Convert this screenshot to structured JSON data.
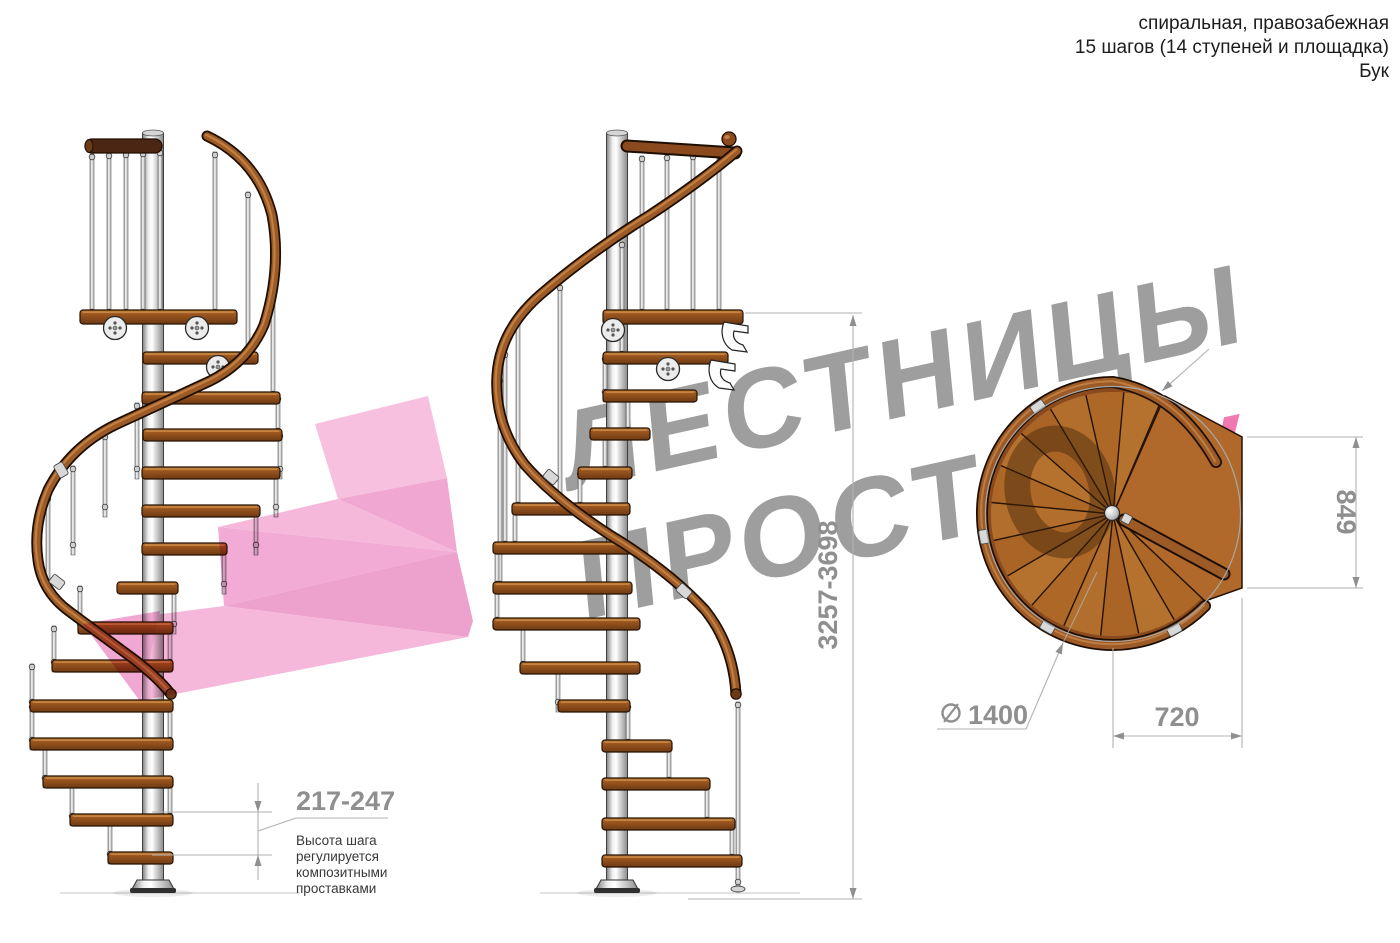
{
  "header": {
    "line1": "спиральная, правозабежная",
    "line2": "15 шагов (14 ступеней и площадка)",
    "line3": "Бук"
  },
  "watermark": {
    "line1": "ЛЕСТНИЦЫ",
    "line2_main": "ПРОСТ",
    "line2_o": "О",
    "line2_suffix": ".ру",
    "gray": "#9e9e9e",
    "pink": "#ef79b0"
  },
  "dimensions": {
    "step_height": "217-247",
    "total_height": "3257-3698",
    "landing_width": "849",
    "landing_depth": "720",
    "diameter_value": "1400",
    "diameter_symbol": "diameter-icon",
    "note_lines": [
      "Высота шага",
      "регулируется",
      "композитными",
      "проставками"
    ]
  },
  "plan": {
    "tread_sectors": 14,
    "has_landing": true
  },
  "colors": {
    "wood": "#a96426",
    "wood_dark": "#6e3a14",
    "rail": "#9c5a26",
    "pole": "#d9d9d9",
    "dim_gray": "#8f8f8f",
    "watermark_gray": "#9e9e9e",
    "accent_pink": "#ef79b0",
    "arrow_pink_light": "#f5b8da",
    "arrow_pink_dark": "#eda2cd"
  }
}
